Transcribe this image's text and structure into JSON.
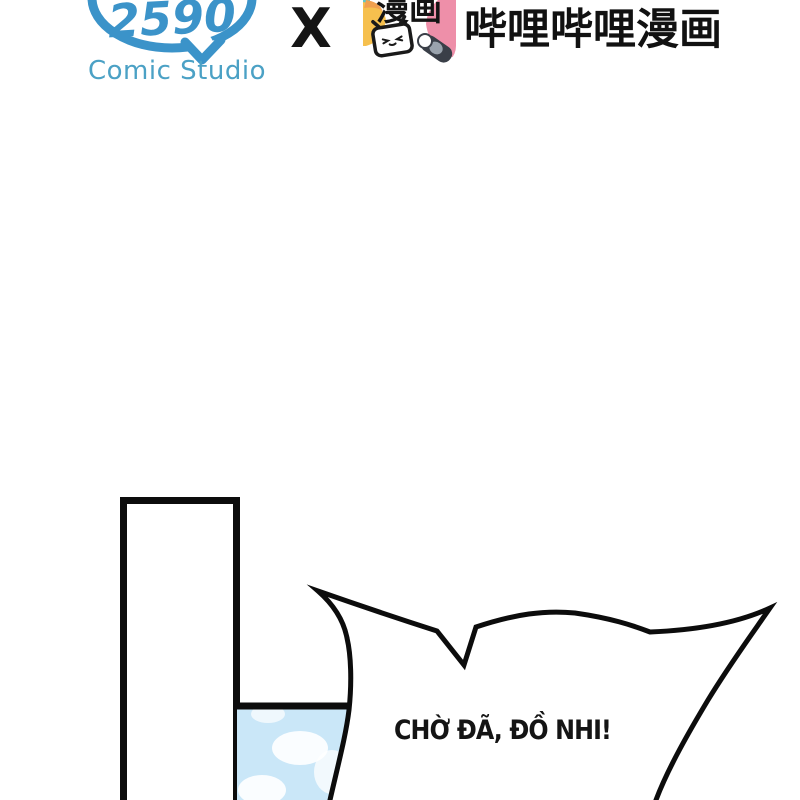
{
  "header": {
    "studio": {
      "logo_number": "2590",
      "label": "Comic Studio",
      "bubble_color": "#3b93c9",
      "label_color": "#4ba1c5"
    },
    "collab": {
      "symbol": "X"
    },
    "publisher": {
      "icon_text": "漫画",
      "title": "哔哩哔哩漫画",
      "icon_colors": {
        "yellow": "#f6c04e",
        "orange": "#f0a050",
        "pink": "#ee8fa9",
        "teal": "#5fc6c9",
        "dark": "#3a3f48"
      }
    }
  },
  "comic": {
    "speech_bubble_text": "CHỜ ĐÃ, ĐỒ NHI!",
    "colors": {
      "outline": "#0c0c0c",
      "sky": "#cae7f8",
      "cloud": "#ffffff"
    }
  }
}
